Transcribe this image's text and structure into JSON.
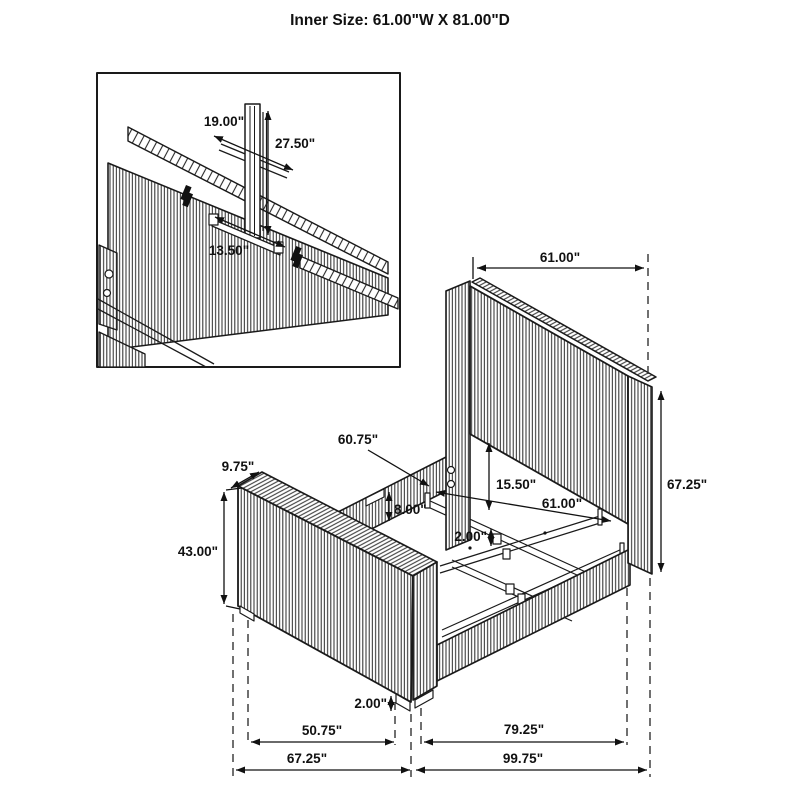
{
  "title": "Inner Size: 61.00\"W X 81.00\"D",
  "drawing": {
    "type": "furniture-assembly-dimension-diagram",
    "subject": "upholstered channel-tufted panel bed, isometric view with dimensions",
    "line_color": "#1a1a1a",
    "background": "#ffffff"
  },
  "inset_dims": {
    "bracket_width": "19.00\"",
    "support_height": "27.50\"",
    "bracket_length": "13.50\""
  },
  "dims": {
    "headboard_width": "61.00\"",
    "headboard_height": "67.25\"",
    "slat_rail_length": "60.75\"",
    "footboard_depth": "9.75\"",
    "footboard_height": "43.00\"",
    "headboard_clearance": "15.50\"",
    "inner_width": "61.00\"",
    "rail_height": "8.00\"",
    "center_leg_height": "2.00\"",
    "foot_leg_height": "2.00\"",
    "footboard_span": "50.75\"",
    "rail_span": "79.25\"",
    "overall_width": "67.25\"",
    "overall_length": "99.75\""
  }
}
